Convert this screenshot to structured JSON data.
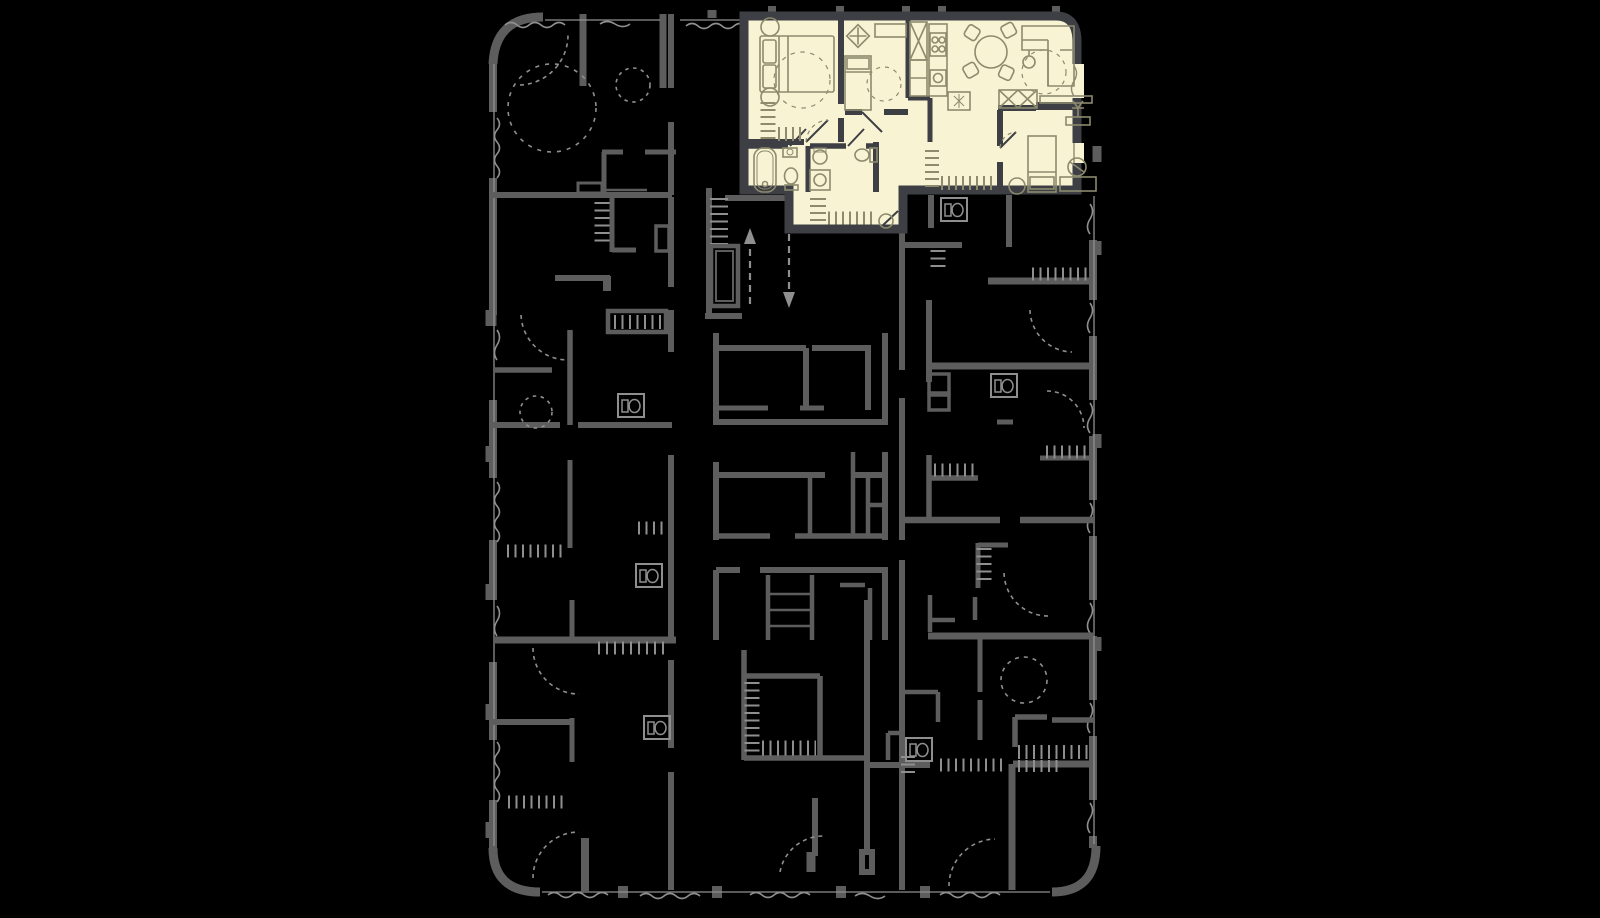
{
  "canvas": {
    "width": 1600,
    "height": 918,
    "background": "#000000"
  },
  "palette": {
    "background": "#000000",
    "plan_wall": "#5d5d5d",
    "plan_light": "#8f8f8f",
    "arrow": "#8f8f8f",
    "unit_fill": "#f8f3d2",
    "unit_wall": "#3d3f44",
    "furniture_line": "#8d8a6e"
  },
  "floor_plan": {
    "kind": "residential-building-floor-plan",
    "orientation": "vertical-slab",
    "highlighted_unit": {
      "state": "selected",
      "position": "top",
      "fill": "#f8f3d2",
      "rooms": [
        "bedroom-1",
        "bedroom-2",
        "kitchen",
        "living-dining-room",
        "bedroom-3",
        "bathroom",
        "shower-wc",
        "hallway",
        "entry-hall"
      ],
      "fixtures_and_furniture": [
        "double-bed",
        "bedside-table",
        "bedside-table",
        "built-in-wardrobe",
        "desk",
        "desk-chair",
        "single-bed",
        "rug",
        "tall-cabinet-fridge",
        "kitchen-counter",
        "hob-4-burner",
        "kitchen-sink",
        "appliance",
        "round-dining-table",
        "dining-chair",
        "dining-chair",
        "dining-chair",
        "dining-chair",
        "corner-sofa",
        "floor-lamp",
        "tv-console",
        "wardrobe-x2",
        "double-bed-2",
        "bedside-table",
        "ottoman",
        "clothes-rack",
        "bench",
        "bathtub",
        "toilet",
        "washbasin",
        "pedestal-sink",
        "wall-hung-toilet",
        "washing-machine",
        "entry-closet",
        "pouf"
      ]
    },
    "common_areas": {
      "staircase": {
        "treads": true,
        "up_arrow": true,
        "down_arrow": true
      },
      "elevator": true,
      "corridor": true
    },
    "symbol_legend": {
      "window": "wavy-line",
      "door_swing": "dashed-arc",
      "built_in_closet": "tick-hatch-strip",
      "wc_unit": "boxed-toilet-icon",
      "party_wall_marker": "small-stub-rect"
    }
  }
}
